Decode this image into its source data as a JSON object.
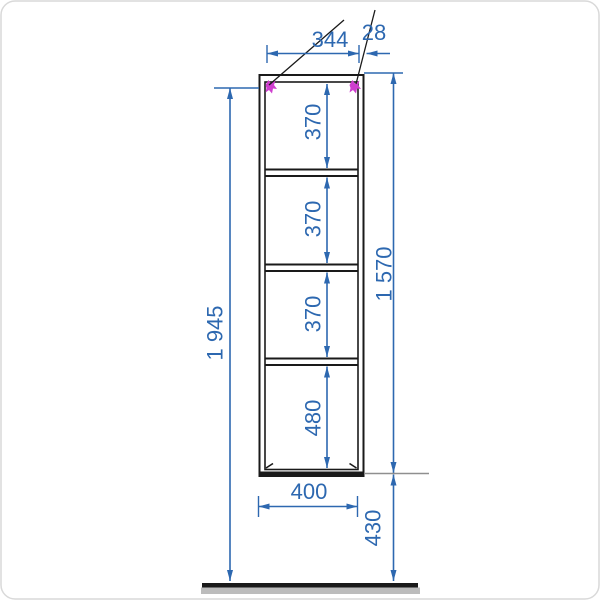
{
  "colors": {
    "background": "#ffffff",
    "frame": "#1a1a1a",
    "dimension": "#2d68b0",
    "leader": "#1a1a1a",
    "marker": "#cf3ecf",
    "extension": "#8f8f8f",
    "floor_line": "#1a1a1a",
    "floor_shadow": "#bcbcbc",
    "canvas_border": "#d9d9d9"
  },
  "drawing": {
    "type": "furniture-dimension-drawing",
    "subject": "tall open shelf unit, front elevation",
    "dims": {
      "inner_width": {
        "label": "344"
      },
      "panel_thickness": {
        "label": "28"
      },
      "shelf_gap_1": {
        "label": "370"
      },
      "shelf_gap_2": {
        "label": "370"
      },
      "shelf_gap_3": {
        "label": "370"
      },
      "shelf_gap_4": {
        "label": "480"
      },
      "overall_height": {
        "label": "1 945"
      },
      "unit_height": {
        "label": "1 570"
      },
      "outer_width": {
        "label": "400"
      },
      "floor_clearance": {
        "label": "430"
      }
    }
  }
}
